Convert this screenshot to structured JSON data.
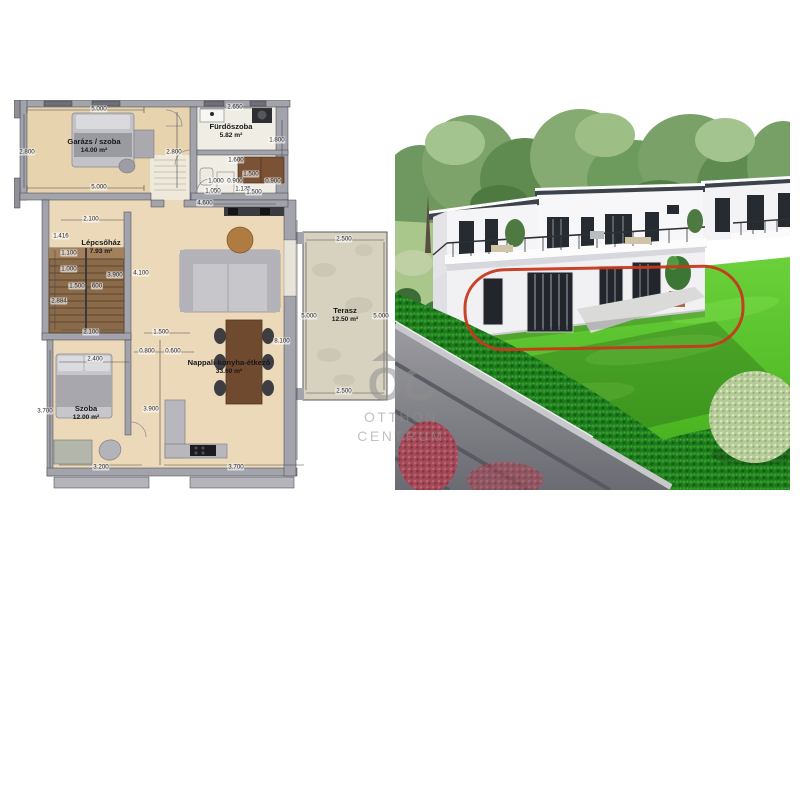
{
  "page": {
    "background": "#ffffff"
  },
  "floor_plan": {
    "rooms": [
      {
        "name": "Garázs / szoba",
        "area": "14.00 m²",
        "x": 80,
        "y": 46
      },
      {
        "name": "Fürdőszoba",
        "area": "5.82 m²",
        "x": 217,
        "y": 31
      },
      {
        "name": "Lépcsőház",
        "area": "7.93 m²",
        "x": 87,
        "y": 147
      },
      {
        "name": "Nappali-konyha-étkező",
        "area": "33.60 m²",
        "x": 215,
        "y": 267
      },
      {
        "name": "Szoba",
        "area": "12.00 m²",
        "x": 72,
        "y": 313
      },
      {
        "name": "Terasz",
        "area": "12.50 m²",
        "x": 331,
        "y": 215
      }
    ],
    "dimensions": [
      {
        "t": "5.000",
        "x": 85,
        "y": 9
      },
      {
        "t": "2.650",
        "x": 221,
        "y": 7
      },
      {
        "t": "2.800",
        "x": 13,
        "y": 52
      },
      {
        "t": "2.800",
        "x": 160,
        "y": 52
      },
      {
        "t": "1.800",
        "x": 263,
        "y": 40
      },
      {
        "t": "5.000",
        "x": 85,
        "y": 87
      },
      {
        "t": "1.600",
        "x": 222,
        "y": 60
      },
      {
        "t": "1.500",
        "x": 237,
        "y": 74
      },
      {
        "t": "1.000",
        "x": 202,
        "y": 81
      },
      {
        "t": "0.900",
        "x": 221,
        "y": 81
      },
      {
        "t": "0.900",
        "x": 259,
        "y": 81
      },
      {
        "t": "1.050",
        "x": 199,
        "y": 91
      },
      {
        "t": "1.135",
        "x": 229,
        "y": 89
      },
      {
        "t": "1.500",
        "x": 240,
        "y": 92
      },
      {
        "t": "4.600",
        "x": 191,
        "y": 103
      },
      {
        "t": "2.100",
        "x": 77,
        "y": 119
      },
      {
        "t": "1.416",
        "x": 47,
        "y": 136
      },
      {
        "t": "1.100",
        "x": 55,
        "y": 153
      },
      {
        "t": "1.000",
        "x": 55,
        "y": 169
      },
      {
        "t": "3.900",
        "x": 101,
        "y": 175
      },
      {
        "t": "4.100",
        "x": 127,
        "y": 173
      },
      {
        "t": "1.500",
        "x": 63,
        "y": 186
      },
      {
        "t": "600",
        "x": 83,
        "y": 186
      },
      {
        "t": "2.884",
        "x": 45,
        "y": 201
      },
      {
        "t": "2.100",
        "x": 77,
        "y": 232
      },
      {
        "t": "1.500",
        "x": 147,
        "y": 232
      },
      {
        "t": "0.800",
        "x": 133,
        "y": 251
      },
      {
        "t": "0.600",
        "x": 159,
        "y": 251
      },
      {
        "t": "2.400",
        "x": 81,
        "y": 259
      },
      {
        "t": "8.100",
        "x": 268,
        "y": 241
      },
      {
        "t": "3.900",
        "x": 137,
        "y": 309
      },
      {
        "t": "3.700",
        "x": 31,
        "y": 311
      },
      {
        "t": "3.200",
        "x": 87,
        "y": 367
      },
      {
        "t": "3.700",
        "x": 222,
        "y": 367
      },
      {
        "t": "2.500",
        "x": 330,
        "y": 139
      },
      {
        "t": "5.000",
        "x": 295,
        "y": 216
      },
      {
        "t": "5.000",
        "x": 367,
        "y": 216
      },
      {
        "t": "2.500",
        "x": 330,
        "y": 291
      }
    ]
  },
  "photo": {
    "highlight_shape": "rounded-rectangle",
    "highlight_color": "#c6391d",
    "colors": {
      "lawn": "#57c22e",
      "hedge": "#1f7a1f",
      "roof": "#3d434b",
      "wall": "#f6f6f8",
      "window": "#23282e",
      "road": "#8e8f96",
      "red_bush": "#a84655",
      "sage_shrub": "#b5cc98",
      "trees": "#769e63"
    }
  },
  "watermark": {
    "logo": "OC",
    "line1": "OTTHON",
    "line2": "CENTRUM"
  }
}
